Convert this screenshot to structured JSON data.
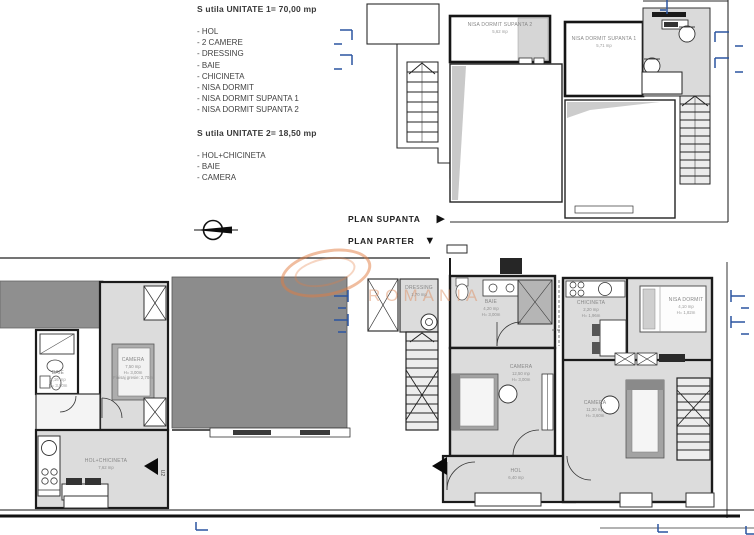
{
  "legend": {
    "unit1_title": "S utila UNITATE 1= 70,00 mp",
    "unit1_items": [
      "- HOL",
      "- 2 CAMERE",
      "- DRESSING",
      "- BAIE",
      "- CHICINETA",
      "- NISA DORMIT",
      "- NISA DORMIT SUPANTA 1",
      "- NISA DORMIT SUPANTA 2"
    ],
    "unit2_title": "S utila UNITATE 2= 18,50 mp",
    "unit2_items": [
      "- HOL+CHICINETA",
      "- BAIE",
      "- CAMERA"
    ]
  },
  "plan_nav": {
    "supanta_label": "PLAN SUPANTA",
    "parter_label": "PLAN PARTER",
    "supanta_icon": "▶",
    "parter_icon": "▼"
  },
  "rooms": {
    "nisa_supanta2": {
      "name": "NISA DORMIT SUPANTA 2",
      "area": "5,62 mp"
    },
    "nisa_supanta1": {
      "name": "NISA DORMIT SUPANTA 1",
      "area": "5,71 mp"
    },
    "camera_unit2": {
      "name": "CAMERA",
      "area": "7,50 mp",
      "h": "H= 3,00m",
      "finish": "Finisaj gresie: 2,70m"
    },
    "baie_unit2": {
      "name": "BAIE",
      "area": "2,16 mp",
      "h": "H= 3,00m"
    },
    "hol_chicineta": {
      "name": "HOL+CHICINETA",
      "area": "7,62 mp"
    },
    "dressing": {
      "name": "DRESSING",
      "area": "1,70 mp"
    },
    "baie_unit1": {
      "name": "BAIE",
      "area": "4,20 mp",
      "h": "H= 3,00m"
    },
    "camera_unit1": {
      "name": "CAMERA",
      "area": "12,50 mp",
      "h": "H= 3,00m"
    },
    "chicineta": {
      "name": "CHICINETA",
      "area": "2,20 mp",
      "h": "H= 1,96m"
    },
    "nisa_dormit": {
      "name": "NISA DORMIT",
      "area": "4,10 mp",
      "h": "H= 1,82m"
    },
    "camera_right": {
      "name": "CAMERA",
      "area": "11,30 mp",
      "h": "H= 3,60m"
    },
    "hol_unit1": {
      "name": "HOL",
      "area": "6,40 mp"
    }
  },
  "doors": {
    "u2_label": "U2"
  },
  "watermark": {
    "text": "ROMANIA"
  },
  "colors": {
    "section_blue": "#2b55a0",
    "watermark_orange": "#e07a3f",
    "floor_gray": "#dcdcdc",
    "block_gray": "#8c8c8c",
    "wall_black": "#1b1b1b"
  }
}
